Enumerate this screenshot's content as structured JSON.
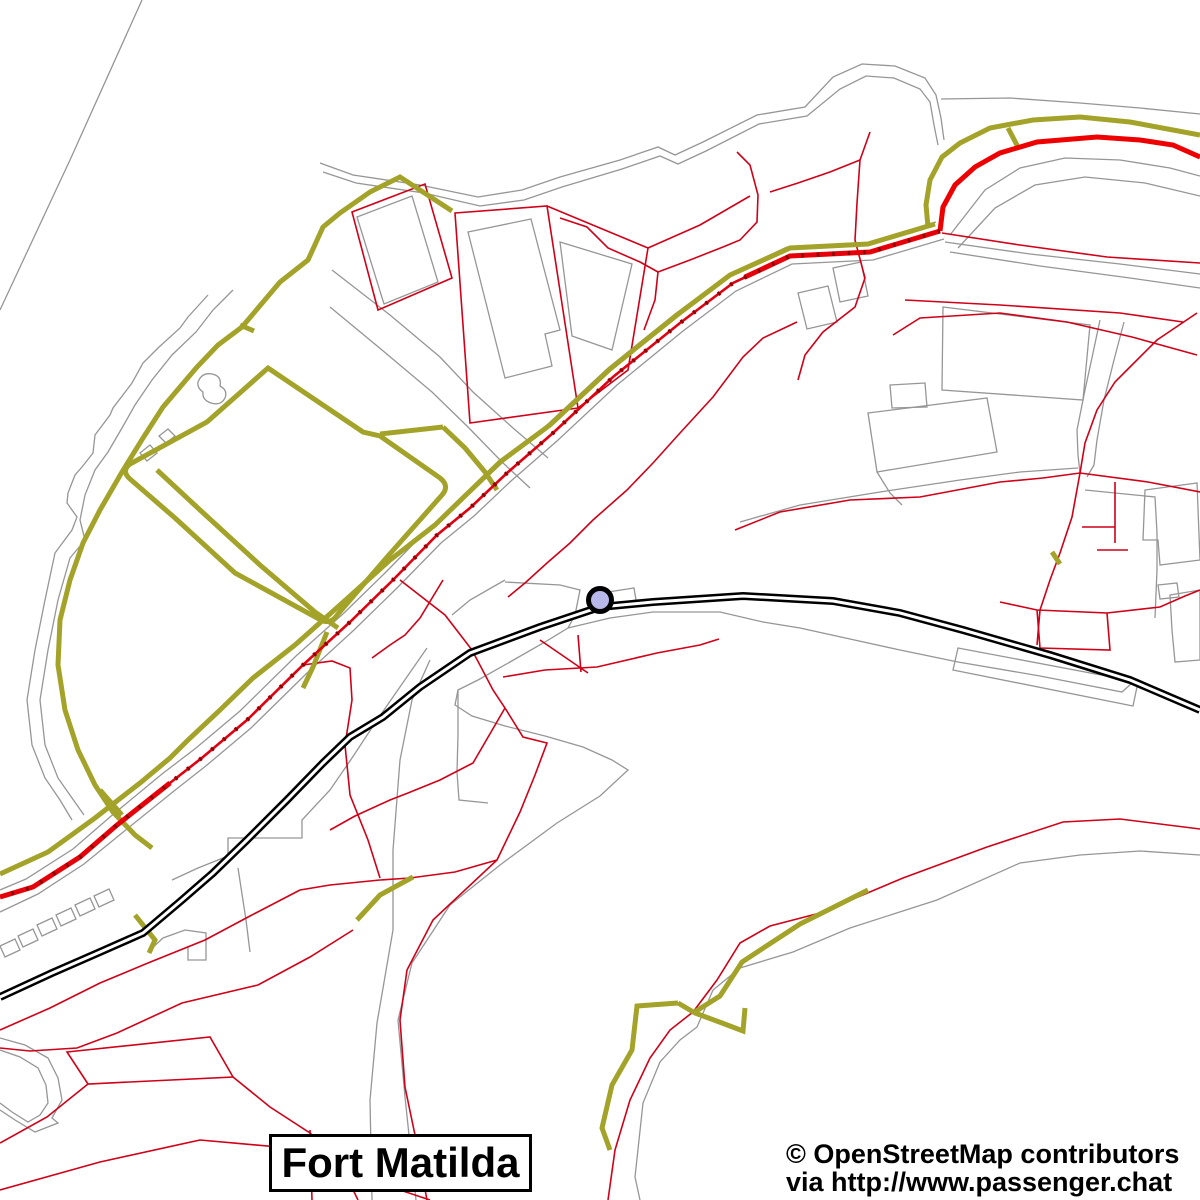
{
  "map": {
    "place_label": {
      "text": "Fort Matilda"
    },
    "attribution": {
      "line1": "© OpenStreetMap contributors",
      "line2": "via http://www.passenger.chat"
    },
    "station_marker": {
      "name": "railway-station-marker",
      "cx": 600,
      "cy": 600,
      "r": 11.5,
      "fill": "#b7b7ea",
      "stroke": "#000000",
      "stroke_width": 5
    },
    "palette": {
      "background": "#ffffff",
      "boundary_gray": "#969696",
      "path_red_thin": "#cf0018",
      "road_red_thick": "#ee0000",
      "road_red_center": "#e00010",
      "oneway_marks": "#8b0000",
      "track_olive": "#a3a32a",
      "railway_black": "#000000",
      "railway_gap": "#ffffff"
    },
    "layers": [
      {
        "name": "gray-boundaries",
        "stroke": "#969696",
        "width": 1.3,
        "paths": [
          "M142,0 L70,160 L0,310",
          "M320,163 L353,175 L420,185 L478,197 L522,190 L560,177 L620,160 L658,147 L675,155 L703,142 L757,115 L805,107 L833,77 L862,64 L895,66 L925,78 L936,95 L941,118 L944,140",
          "M323,172 L356,183 L424,193 L480,206 L524,200 L562,187 L622,169 L660,156 L678,164 L706,151 L759,124 L807,116 L840,89 L866,76 L894,78 L920,89 L930,102 L934,125 L938,145",
          "M208,295 L188,317 L180,328 L158,348 L143,363 L132,383 L113,408 L110,415 L95,435 L93,453 L82,467 L75,475 L68,493 L67,503 L77,517 L72,530 L55,553 L45,600 L35,650 L27,700 L32,745 L45,778 L60,800 L72,820",
          "M233,290 L213,310 L196,332 L172,355 L152,380 L135,405 L122,428 L108,452 L95,470 L85,495 L80,520 L85,540 L70,558 L58,600 L48,650 L40,700 L45,745 L58,778 L72,798 L84,815",
          "M332,270 L390,315 L440,357 L473,392 L513,428 L548,458",
          "M330,307 L382,350 L432,392 L468,427 L502,462 L530,488",
          "M936,222 L866,243 L787,247 L729,274 L675,314 L608,368 L548,424 L501,464 L464,499 L431,526 L387,571 L344,613 L296,656 L240,711 L196,748 L162,774 L110,817 L73,849 L26,879 L0,890",
          "M944,239 L873,260 L792,264 L736,291 L683,331 L617,385 L557,441 L511,481 L474,516 L441,543 L397,588 L354,630 L307,673 L251,728 L207,765 L174,791 L122,833 L84,864 L38,894 L0,912",
          "M505,582 L560,585 L580,590 L575,615 L568,628",
          "M608,592 L634,588 L636,600 L610,604 Z",
          "M452,615 L470,600 L505,580",
          "M568,628 L610,618 L653,612 L720,612 L763,622 L800,628 L850,639 L900,650 L958,662 L1040,676 L1122,692 L1132,683",
          "M568,628 L545,642 L510,662 L478,680 L458,690 L455,705 L472,716 L505,726 L545,736 L583,747 L612,760 L628,770 L600,796 L557,823 L500,865 L450,905 L412,963 L398,1020 L405,1097 L413,1173 L416,1200",
          "M458,690 L458,735 L457,772 L459,800 L488,803",
          "M430,660 L412,700 L400,760 L393,850 L393,930 L377,1023 L370,1100 L372,1200",
          "M640,1200 L635,1177 L643,1103 L660,1062 L680,1040 L697,1027 L713,990 L740,968 L793,952 L850,928 L937,900 L1020,863 L1080,855 L1140,851 L1200,855",
          "M1100,320 L1093,353 L1085,390 L1077,430 L1078,455 L1080,473",
          "M1124,322 L1114,360 L1104,400 L1097,440 L1094,465 L1087,477",
          "M1085,490 L1155,497 L1157,533 L1157,570 L1155,618",
          "M740,522 L800,505 L880,492 L960,480 L1020,472 L1078,468",
          "M941,99 L1010,98 L1080,103 L1140,108 L1200,114",
          "M950,235 L985,190 L1020,168 L1065,158 L1120,160 L1170,168 L1200,176",
          "M958,248 L995,208 L1035,185 L1085,177 L1145,183 L1200,196",
          "M945,242 L1030,254 L1120,264 L1200,274",
          "M950,252 L1040,266 L1130,278 L1200,288",
          "M943,307 L1090,325 L1083,400 L942,390 Z",
          "M868,413 L987,398 L997,452 L877,472 Z",
          "M890,385 L925,383 L927,407 L892,408 Z",
          "M798,293 L828,286 L837,322 L807,329 Z",
          "M833,268 L861,262 L868,296 L840,302 Z",
          "M877,472 L890,493 L902,505",
          "M357,217 L412,196 L438,282 L384,304 Z",
          "M468,232 L531,219 L560,330 L545,334 L552,366 L505,378 Z",
          "M560,242 L632,264 L612,350 L572,336 Z",
          "M198,382 Q202,372 212,374 Q222,376 220,386 Q228,390 225,398 Q221,406 211,403 Q202,400 203,392 Q197,388 198,382 Z",
          "M140,453 L150,445 L157,453 L147,461 Z",
          "M159,436 L168,429 L175,436 L166,443 Z",
          "M94,896 L109,889 L114,900 L99,907 Z",
          "M75,905 L90,898 L95,909 L80,916 Z",
          "M56,915 L71,908 L76,919 L61,926 Z",
          "M37,925 L52,918 L57,929 L42,936 Z",
          "M18,936 L33,929 L38,940 L23,947 Z",
          "M0,946 L15,939 L20,950 L5,957 Z",
          "M0,1038 L25,1045 L48,1058 L58,1078 L62,1100 L52,1118 L58,1123 L35,1132 L15,1120 L0,1110",
          "M0,1050 L20,1057 L38,1068 L46,1085 L48,1103 L40,1115 L28,1122 L12,1112 L0,1103",
          "M150,950 L163,938 L185,930 L206,933 L206,960 L188,960 L188,946",
          "M427,648 L377,720 L352,758 L330,790 L302,820 L302,838 L228,838 L228,856 L198,868 L172,880",
          "M238,868 L246,920 L250,952",
          "M1145,490 L1197,483 L1200,560 L1160,565 L1158,540 L1143,540 Z",
          "M1170,595 L1200,590 L1200,660 L1175,662 L1172,630 Z",
          "M1158,585 L1177,583 L1179,597 L1160,599 Z",
          "M958,648 L1138,682 L1133,706 L953,670 Z"
        ]
      },
      {
        "name": "red-paths",
        "stroke": "#cf0018",
        "width": 1.6,
        "paths": [
          "M870,132 L860,160 L857,203 L855,240 L865,278 L855,307 L823,332 L805,355 L798,380",
          "M860,160 L830,172 L798,183 L770,192",
          "M560,218 L587,227 L608,248 L640,262 L658,272 L655,300 L644,330",
          "M658,272 L690,260 L723,247 L740,240 L757,222 L758,195 L750,165 L737,152",
          "M352,212 L425,184 L452,278 L378,310 Z",
          "M455,213 L547,206 L578,408 L470,423 Z",
          "M547,206 L648,248 L628,370 L578,408",
          "M648,248 L700,225 L750,196",
          "M797,322 L763,338 L743,357 L713,397 L680,433 L653,463 L627,490 L593,520 L570,543 L547,563 L525,583 L508,597",
          "M893,335 L920,318 L1000,313 L1067,322 L1132,337 L1197,355",
          "M905,300 L1000,305 L1120,313 L1183,322",
          "M1197,313 L1157,340 L1130,367 L1115,382 L1097,410 L1085,443 L1080,473",
          "M735,530 L780,512 L850,500 L920,497 L1000,482 L1043,478 L1080,473 L1148,482 L1200,492",
          "M1080,473 L1072,517 L1060,553 L1050,580 L1040,610 L1037,645",
          "M1115,482 L1115,543 M1082,527 L1115,527 M1097,550 L1128,550",
          "M1037,610 L1107,613 L1110,650 L1040,648 Z M1000,602 L1037,610 M1107,613 L1160,607 L1185,596 L1200,590",
          "M942,233 L1020,245 L1107,257 L1200,263",
          "M443,580 L420,618 L405,635 L390,645 L372,658",
          "M400,580 L445,615 L472,650 L493,690 L505,708 L523,737 L547,743 L535,775 L520,812 L497,860 L433,920 L407,970 L400,1020 L405,1087 L415,1135 L427,1200",
          "M505,708 L473,763 L440,780 L408,793 L390,800 L355,816 L330,830",
          "M497,860 L455,872 L410,878 L380,880 L330,885 L300,890",
          "M303,665 L332,661 L350,668 L352,700 L345,745 L350,795 L368,840 L380,878",
          "M578,635 L581,672 M540,640 L588,673",
          "M503,677 L545,670 L597,667 L657,653 L700,645 L719,639",
          "M0,1030 L50,1008 L100,983 L148,963 L205,940 L250,916 L300,890",
          "M353,930 L310,957 L258,985 L182,1003 L117,1033 L77,1048 L30,1051 L0,1048",
          "M67,1052 L210,1037 L233,1077 L88,1084 Z",
          "M0,1143 L47,1117 L88,1084",
          "M233,1077 L270,1107 L310,1133 L340,1163 L358,1200",
          "M0,1190 L100,1162 L200,1140 L290,1148 L370,1180 L430,1200",
          "M310,1130 L312,1200",
          "M608,1200 L615,1150 L630,1100 L650,1058 L670,1030 L693,1012 L717,980 L740,943 L770,926 L820,913 L903,878 L987,847 L1063,822 L1120,819 L1200,829"
        ]
      },
      {
        "name": "olive-tracks",
        "stroke": "#a3a32a",
        "width": 5,
        "paths": [
          "M452,211 L400,177 L370,192 L340,213 L323,227 L308,260 L280,282 L242,327 L218,345 L197,367 L163,407 L143,438 L122,472 L100,510 L83,543 L70,580 L60,620 L58,665 L65,710 L78,750 L95,785 L113,812 L135,835 L152,848",
          "M268,368 L363,432 L380,436 L440,478 Q450,486 442,495 L388,556 L338,614 Q330,626 319,619 L235,573 L175,518 L130,479 Q121,471 130,464 L207,422 Z",
          "M157,470 L200,510 L260,565 L315,612 L338,628",
          "M327,632 L313,667 L303,688",
          "M935,224 L868,244 L790,248 L730,275 L677,315 L610,369 L550,425 L500,462 L435,525 L390,560 L340,605 L295,645 L253,678 L220,710 L188,740 L170,758 L140,783 L95,818 L48,852 L0,874",
          "M1200,135 L1173,130 L1130,122 L1080,117 L1033,120 L990,128 L960,143 L942,157 L930,180 L926,205 L928,227",
          "M1008,128 L1019,149",
          "M380,434 L443,427 M443,427 L465,448 L485,472 L497,490",
          "M610,1150 L602,1128 L612,1085 L632,1050 L637,1006 L678,1003",
          "M678,1003 L695,1013 L722,1023 L743,1031 L745,1008",
          "M693,1013 L720,996 L742,962 L800,924 L868,890",
          "M357,920 L380,895 L413,877",
          "M100,790 L122,815",
          "M135,915 L155,940 L149,953",
          "M1052,552 L1060,564",
          "M240,325 L254,331"
        ]
      },
      {
        "name": "red-primary-roads",
        "stroke": "#ee0000",
        "width": 5,
        "paths": [
          "M1200,157 L1173,145 L1140,140 L1097,137 L1037,142 L1000,153 L975,167 L955,185 L943,207 L940,231",
          "M940,231 L870,252 L790,256 L745,277",
          "M170,783 L117,825 L80,857 L33,887 L0,897"
        ]
      },
      {
        "name": "main-road-centerline",
        "stroke": "#e00010",
        "width": 2.6,
        "paths": [
          "M940,231 L870,252 L790,256 L733,283 L680,323 L613,377 L553,433 L507,473 L470,508 L437,535 L393,580 L350,622 L303,665 L247,720 L203,757 L170,783 L117,825 L80,857 L33,887 L0,897"
        ]
      },
      {
        "name": "main-road-oneway-marks",
        "stroke": "#8b0000",
        "width": 4.2,
        "dash": "2.5 13",
        "paths": [
          "M940,231 L870,252 L790,256 L733,283 L680,323 L613,377 L553,433 L507,473 L470,508 L437,535 L393,580 L350,622 L303,665 L247,720 L203,757 L170,783 L117,825 L80,857 L33,887 L0,897"
        ]
      },
      {
        "name": "railway-bed",
        "stroke": "#000000",
        "width": 8,
        "paths": [
          "M0,997 L52,973 L100,952 L143,933 L182,900 L213,873 L247,840 L287,800 L323,763 L350,737 L383,717 L420,687 L470,653 L540,627 L600,607 L653,602 L743,596 L833,601 L900,613 L963,630 L1050,655 L1130,680 L1200,710"
        ]
      },
      {
        "name": "railway-gap",
        "stroke": "#ffffff",
        "width": 3,
        "paths": [
          "M0,997 L52,973 L100,952 L143,933 L182,900 L213,873 L247,840 L287,800 L323,763 L350,737 L383,717 L420,687 L470,653 L540,627 L600,607 L653,602 L743,596 L833,601 L900,613 L963,630 L1050,655 L1130,680 L1200,710"
        ]
      }
    ]
  }
}
